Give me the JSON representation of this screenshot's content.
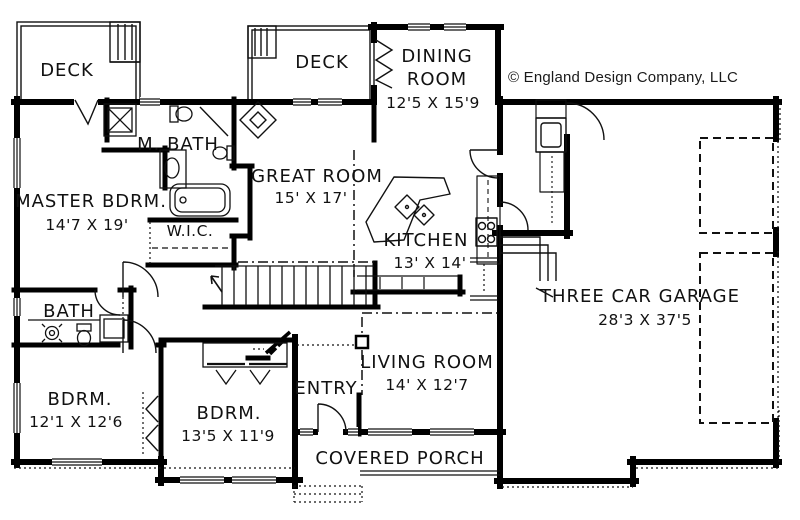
{
  "copyright": "© England Design Company, LLC",
  "rooms": {
    "deck_left": {
      "label": "DECK"
    },
    "deck_middle": {
      "label": "DECK"
    },
    "dining_room": {
      "label_line1": "DINING",
      "label_line2": "ROOM",
      "dims": "12'5 X 15'9"
    },
    "master_bath": {
      "label": "M. BATH"
    },
    "master_bedroom": {
      "label": "MASTER BDRM.",
      "dims": "14'7 X 19'"
    },
    "great_room": {
      "label": "GREAT ROOM",
      "dims": "15' X 17'"
    },
    "walk_in_closet": {
      "label": "W.I.C."
    },
    "kitchen": {
      "label": "KITCHEN",
      "dims": "13' X 14'"
    },
    "garage": {
      "label": "THREE CAR GARAGE",
      "dims": "28'3 X 37'5"
    },
    "bath": {
      "label": "BATH"
    },
    "bedroom_left": {
      "label": "BDRM.",
      "dims": "12'1 X 12'6"
    },
    "bedroom_middle": {
      "label": "BDRM.",
      "dims": "13'5 X 11'9"
    },
    "entry": {
      "label": "ENTRY"
    },
    "living_room": {
      "label": "LIVING ROOM",
      "dims": "14' X 12'7"
    },
    "covered_porch": {
      "label": "COVERED PORCH"
    }
  }
}
